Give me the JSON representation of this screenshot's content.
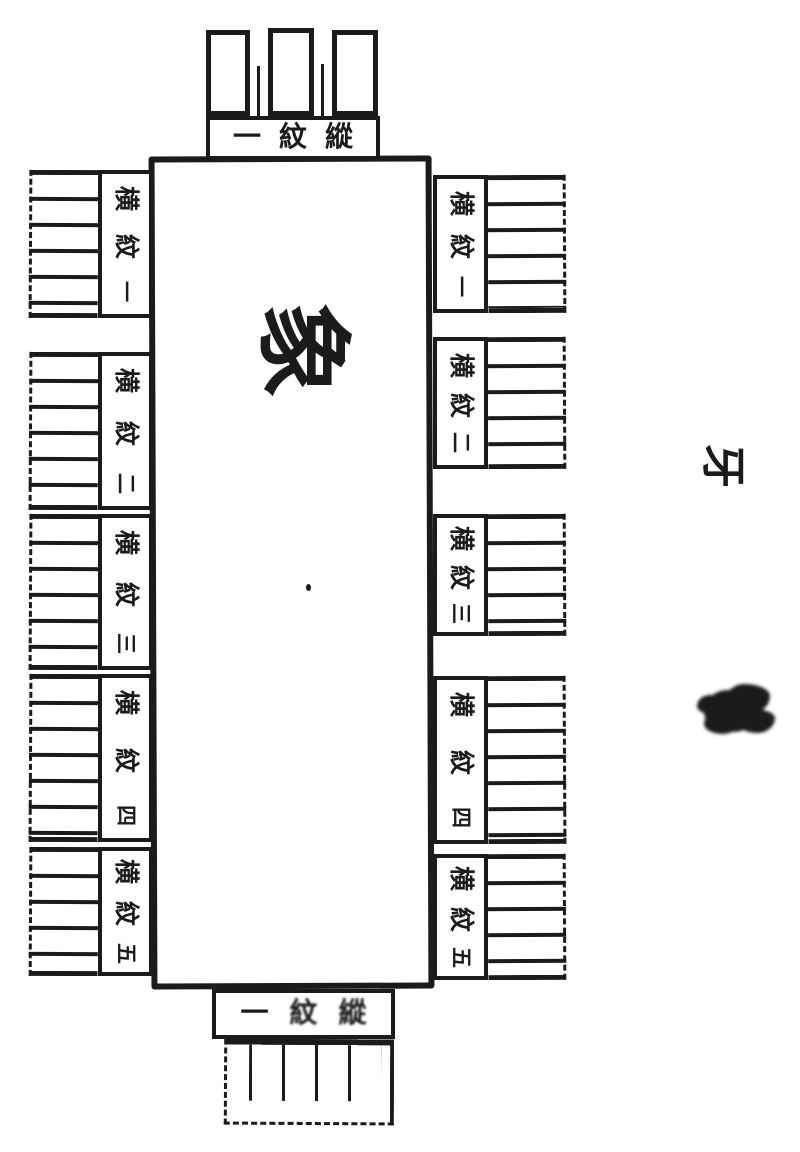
{
  "colors": {
    "ink": "#1b1b1b",
    "paper": "#ffffff"
  },
  "center": {
    "char": "象"
  },
  "top_label": {
    "text": "一紋縱",
    "chars": [
      "一",
      "紋",
      "縱"
    ]
  },
  "bottom_label": {
    "text": "一紋縱",
    "chars": [
      "一",
      "紋",
      "縱"
    ]
  },
  "left_labels": [
    {
      "text": "横紋一",
      "chars": [
        "横",
        "紋",
        "一"
      ]
    },
    {
      "text": "横紋二",
      "chars": [
        "横",
        "紋",
        "二"
      ]
    },
    {
      "text": "横紋三",
      "chars": [
        "横",
        "紋",
        "三"
      ]
    },
    {
      "text": "横紋四",
      "chars": [
        "横",
        "紋",
        "四"
      ]
    },
    {
      "text": "横紋五",
      "chars": [
        "横",
        "紋",
        "五"
      ]
    }
  ],
  "right_labels": [
    {
      "text": "横紋一",
      "chars": [
        "横",
        "紋",
        "一"
      ]
    },
    {
      "text": "横紋二",
      "chars": [
        "横",
        "紋",
        "二"
      ]
    },
    {
      "text": "横紋三",
      "chars": [
        "横",
        "紋",
        "三"
      ]
    },
    {
      "text": "横紋四",
      "chars": [
        "横",
        "紋",
        "四"
      ]
    },
    {
      "text": "横紋五",
      "chars": [
        "横",
        "紋",
        "五"
      ]
    }
  ],
  "margin": {
    "folio_char": "牙"
  }
}
